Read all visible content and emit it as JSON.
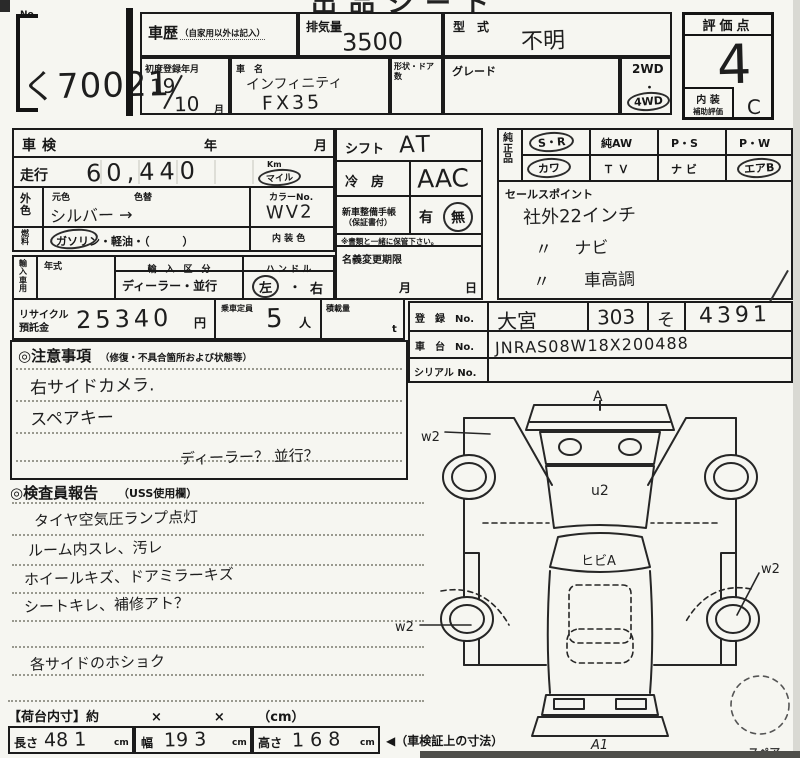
{
  "page": {
    "top_title_partial": "出品シート",
    "no_label": "No.",
    "lot_number": "く70021"
  },
  "header": {
    "shareki_label": "車歴",
    "shareki_note": "（自家用以外は記入）",
    "haikiryo_label": "排気量",
    "haikiryo_value": "3500",
    "katashiki_label": "型　式",
    "katashiki_value": "不明",
    "first_reg_label": "初度登録年月",
    "first_reg_year": "19",
    "first_reg_month": "10",
    "month_suffix": "月",
    "car_name_label": "車　名",
    "car_name_line1": "インフィニティ",
    "car_name_line2": "FX35",
    "shape_door_label": "形状・ドア数",
    "grade_label": "グレード",
    "drive_2wd": "2WD",
    "drive_dot": "・",
    "drive_4wd": "4WD",
    "hyokaten_label": "評価点",
    "hyokaten_value": "4",
    "naiso_label": "内 装",
    "naiso_sub_label": "補助評価",
    "naiso_value": "C"
  },
  "left": {
    "shaken_label": "車検",
    "year_label": "年",
    "month_label": "月",
    "soko_label": "走行",
    "soko_value": "60,440",
    "km_label": "Km",
    "mile_label": "マイル",
    "gaishoku_label": "外色",
    "motoiro_label": "元色",
    "irogae_label": "色替",
    "color_value": "シルバー →",
    "color_no_label": "カラーNo.",
    "color_no_value": "WV2",
    "fuel_label": "燃料",
    "fuel_options": "ガソリン・軽油・（　　　）",
    "naiso_color_label": "内 装 色",
    "import_label": "輸入車用",
    "nenshiki_label": "年式",
    "import_kubun_label": "輸　入　区　分",
    "import_kubun_value": "ディーラー・並行",
    "handle_label": "ハ ン ド ル",
    "handle_left": "左",
    "handle_dot": "・",
    "handle_right": "右",
    "recycle_label1": "リサイクル",
    "recycle_label2": "預託金",
    "recycle_value": "25340",
    "yen_label": "円",
    "teiin_label": "乗車定員",
    "teiin_value": "5",
    "nin_label": "人",
    "sekisai_label": "積載量",
    "ton_label": "t"
  },
  "center": {
    "shift_label": "シフト",
    "shift_value": "AT",
    "aircon_label": "冷　房",
    "aircon_value": "AAC",
    "techo_label1": "新車整備手帳",
    "techo_label2": "（保証書付）",
    "ari_label": "有",
    "nashi_label": "無",
    "hokan_note": "※書類と一緒に保管下さい。",
    "meigi_label": "名義変更期限",
    "meigi_month": "月",
    "meigi_day": "日"
  },
  "options": {
    "junsei_label": "純正品",
    "sr": "S・R",
    "aw": "純AW",
    "ps": "P・S",
    "pw": "P・W",
    "kawa": "カワ",
    "tv": "Ｔ Ｖ",
    "navi": "ナ ビ",
    "airb": "エアB"
  },
  "sales": {
    "label": "セールスポイント",
    "line1": "社外22インチ",
    "line2": "〃　 ナビ",
    "line3": "〃　　車高調"
  },
  "reg": {
    "touroku_label": "登　録　No.",
    "area": "大宮",
    "class_no": "303",
    "kana": "そ",
    "number": "4391",
    "shadai_label": "車　台　No.",
    "shadai_value": "JNRAS08W18X200488",
    "serial_label": "シリアル No."
  },
  "chui": {
    "title": "◎注意事項",
    "subtitle": "（修復・不具合箇所および状態等）",
    "line1": "右サイドカメラ.",
    "line2": "スペアキー",
    "line3": "ディーラー？ 並行？"
  },
  "kensain": {
    "title": "◎検査員報告",
    "subtitle": "（USS使用欄）",
    "line1": "タイヤ空気圧ランプ点灯",
    "line2": "ルーム内スレ、汚レ",
    "line3": "ホイールキズ、ドアミラーキズ",
    "line4": "シートキレ、補修アト？",
    "line5": "各サイドのホショク"
  },
  "dims": {
    "title_line": "【荷台内寸】約　　　　×　　　　×　　　（cm）",
    "length_label": "長さ",
    "length_value": "48 1",
    "width_label": "幅",
    "width_value": "19 3",
    "height_label": "高さ",
    "height_value": "1 6 8",
    "cm_label": "cm",
    "arrow_note": "◀（車検証上の寸法）"
  },
  "diagram": {
    "front_mark": "A",
    "left_front_mark": "w2",
    "hood_mark": "u2",
    "windshield_mark": "ヒビA",
    "left_rear_mark": "w2",
    "right_rear_mark": "w2",
    "rear_mark": "A1",
    "spare_label": "スペア"
  }
}
